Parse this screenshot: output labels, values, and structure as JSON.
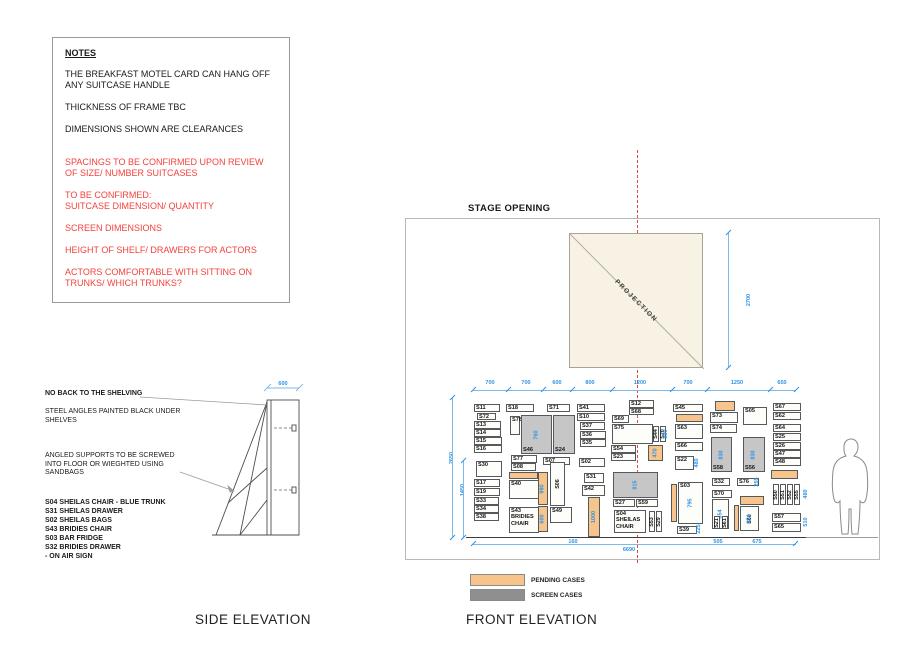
{
  "notes": {
    "title": "NOTES",
    "black_items": [
      "THE BREAKFAST MOTEL CARD CAN HANG OFF ANY SUITCASE HANDLE",
      "THICKNESS OF FRAME TBC",
      "DIMENSIONS SHOWN ARE CLEARANCES"
    ],
    "red_items": [
      "SPACINGS TO BE CONFIRMED UPON REVIEW OF SIZE/ NUMBER SUITCASES",
      "TO BE CONFIRMED:\nSUITCASE DIMENSION/ QUANTITY",
      "SCREEN DIMENSIONS",
      "HEIGHT OF SHELF/ DRAWERS FOR ACTORS",
      "ACTORS COMFORTABLE WITH SITTING ON TRUNKS/ WHICH TRUNKS?"
    ]
  },
  "side_elevation": {
    "title": "SIDE ELEVATION",
    "top_dim": "600",
    "no_back": "NO BACK TO THE SHELVING",
    "steel": "STEEL ANGLES PAINTED BLACK UNDER\nSHELVES",
    "angled": "ANGLED SUPPORTS TO BE SCREWED\nINTO FLOOR OR WIEGHTED USING\nSANDBAGS",
    "case_list": [
      "S04 SHEILAS CHAIR - BLUE TRUNK",
      "S31 SHEILAS DRAWER",
      "S02 SHEILAS BAGS",
      "S43 BRIDIES CHAIR",
      "S03 BAR FRIDGE",
      "S32 BRIDIES DRAWER",
      "- ON AIR SIGN"
    ]
  },
  "front_elevation": {
    "title": "FRONT ELEVATION",
    "stage_label": "STAGE OPENING",
    "projection_label": "PROJECTION",
    "projection_dim": "2700",
    "top_dims": [
      {
        "t": "700",
        "c": 24
      },
      {
        "t": "700",
        "c": 60
      },
      {
        "t": "600",
        "c": 91
      },
      {
        "t": "800",
        "c": 124
      },
      {
        "t": "1200",
        "c": 174
      },
      {
        "t": "700",
        "c": 222
      },
      {
        "t": "1250",
        "c": 271
      },
      {
        "t": "650",
        "c": 316
      }
    ],
    "tick_xs": [
      7,
      42,
      77,
      106,
      146,
      206,
      241,
      304,
      330
    ],
    "cases": [
      {
        "l": "S11",
        "x": 8,
        "y": 6,
        "w": 26,
        "h": 8
      },
      {
        "l": "S72",
        "x": 11,
        "y": 15,
        "w": 19,
        "h": 7
      },
      {
        "l": "S13",
        "x": 8,
        "y": 23,
        "w": 27,
        "h": 8
      },
      {
        "l": "S14",
        "x": 8,
        "y": 31,
        "w": 27,
        "h": 8
      },
      {
        "l": "S15",
        "x": 8,
        "y": 39,
        "w": 28,
        "h": 8
      },
      {
        "l": "S16",
        "x": 8,
        "y": 47,
        "w": 28,
        "h": 8
      },
      {
        "l": "S30",
        "x": 10,
        "y": 63,
        "w": 26,
        "h": 16
      },
      {
        "l": "S17",
        "x": 8,
        "y": 81,
        "w": 26,
        "h": 8
      },
      {
        "l": "S19",
        "x": 8,
        "y": 90,
        "w": 26,
        "h": 8
      },
      {
        "l": "S33",
        "x": 8,
        "y": 99,
        "w": 25,
        "h": 8
      },
      {
        "l": "S34",
        "x": 8,
        "y": 107,
        "w": 25,
        "h": 8
      },
      {
        "l": "S38",
        "x": 8,
        "y": 115,
        "w": 25,
        "h": 8
      },
      {
        "l": "S18",
        "x": 40,
        "y": 6,
        "w": 28,
        "h": 8
      },
      {
        "l": "S78",
        "x": 44,
        "y": 18,
        "w": 10,
        "h": 19
      },
      {
        "l": "S46",
        "x": 55,
        "y": 17,
        "w": 31,
        "h": 39,
        "f": "s",
        "lp": "bl",
        "d": "760"
      },
      {
        "l": "S24",
        "x": 87,
        "y": 17,
        "w": 22,
        "h": 39,
        "f": "s",
        "lp": "bl"
      },
      {
        "l": "S77",
        "x": 45,
        "y": 57,
        "w": 26,
        "h": 8
      },
      {
        "l": "S08",
        "x": 45,
        "y": 65,
        "w": 25,
        "h": 8
      },
      {
        "l": "",
        "x": 43,
        "y": 74,
        "w": 29,
        "h": 7,
        "f": "p"
      },
      {
        "l": "S40",
        "x": 43,
        "y": 82,
        "w": 30,
        "h": 19
      },
      {
        "l": "S43\nBRIDIES\nCHAIR",
        "x": 43,
        "y": 109,
        "w": 30,
        "h": 26
      },
      {
        "l": "S71",
        "x": 81,
        "y": 6,
        "w": 23,
        "h": 8
      },
      {
        "l": "S07",
        "x": 77,
        "y": 59,
        "w": 27,
        "h": 8
      },
      {
        "l": "",
        "x": 72,
        "y": 74,
        "w": 10,
        "h": 33,
        "f": "p",
        "d": "990"
      },
      {
        "l": "",
        "x": 72,
        "y": 108,
        "w": 10,
        "h": 26,
        "f": "p",
        "d": "600"
      },
      {
        "l": "S06",
        "x": 84,
        "y": 64,
        "w": 15,
        "h": 44,
        "v": true
      },
      {
        "l": "S49",
        "x": 84,
        "y": 109,
        "w": 22,
        "h": 16
      },
      {
        "l": "S41",
        "x": 111,
        "y": 6,
        "w": 28,
        "h": 8
      },
      {
        "l": "S10",
        "x": 111,
        "y": 15,
        "w": 28,
        "h": 8
      },
      {
        "l": "S37",
        "x": 114,
        "y": 24,
        "w": 25,
        "h": 8
      },
      {
        "l": "S36",
        "x": 114,
        "y": 33,
        "w": 26,
        "h": 8
      },
      {
        "l": "S35",
        "x": 114,
        "y": 41,
        "w": 26,
        "h": 8
      },
      {
        "l": "S02",
        "x": 113,
        "y": 60,
        "w": 26,
        "h": 9
      },
      {
        "l": "S31",
        "x": 118,
        "y": 75,
        "w": 20,
        "h": 10
      },
      {
        "l": "S42",
        "x": 116,
        "y": 87,
        "w": 23,
        "h": 11
      },
      {
        "l": "",
        "x": 122,
        "y": 99,
        "w": 12,
        "h": 40,
        "f": "p",
        "d": "1000"
      },
      {
        "l": "S12",
        "x": 163,
        "y": 2,
        "w": 25,
        "h": 8
      },
      {
        "l": "S68",
        "x": 163,
        "y": 10,
        "w": 25,
        "h": 7
      },
      {
        "l": "S69",
        "x": 146,
        "y": 17,
        "w": 17,
        "h": 8
      },
      {
        "l": "S75",
        "x": 146,
        "y": 26,
        "w": 41,
        "h": 20
      },
      {
        "l": "S44",
        "x": 187,
        "y": 28,
        "w": 6,
        "h": 16,
        "v": true
      },
      {
        "l": "S20",
        "x": 194,
        "y": 28,
        "w": 6,
        "h": 16,
        "v": true
      },
      {
        "l": "S54",
        "x": 145,
        "y": 47,
        "w": 25,
        "h": 8
      },
      {
        "l": "S23",
        "x": 145,
        "y": 55,
        "w": 25,
        "h": 8
      },
      {
        "l": "",
        "x": 182,
        "y": 47,
        "w": 15,
        "h": 16,
        "f": "p",
        "d": "470"
      },
      {
        "l": "",
        "x": 147,
        "y": 74,
        "w": 45,
        "h": 26,
        "f": "s",
        "d": "815"
      },
      {
        "l": "S27",
        "x": 147,
        "y": 101,
        "w": 22,
        "h": 8
      },
      {
        "l": "S59",
        "x": 170,
        "y": 101,
        "w": 22,
        "h": 8
      },
      {
        "l": "S04\nSHEILAS\nCHAIR",
        "x": 148,
        "y": 112,
        "w": 32,
        "h": 23
      },
      {
        "l": "S53",
        "x": 183,
        "y": 113,
        "w": 6,
        "h": 21,
        "v": true
      },
      {
        "l": "S29",
        "x": 190,
        "y": 113,
        "w": 6,
        "h": 21,
        "v": true
      },
      {
        "l": "S45",
        "x": 207,
        "y": 6,
        "w": 30,
        "h": 8
      },
      {
        "l": "",
        "x": 210,
        "y": 16,
        "w": 27,
        "h": 8,
        "f": "p"
      },
      {
        "l": "S63",
        "x": 209,
        "y": 26,
        "w": 28,
        "h": 15
      },
      {
        "l": "S66",
        "x": 209,
        "y": 44,
        "w": 28,
        "h": 9
      },
      {
        "l": "S22",
        "x": 209,
        "y": 58,
        "w": 19,
        "h": 14
      },
      {
        "l": "",
        "x": 205,
        "y": 86,
        "w": 6,
        "h": 38,
        "f": "p"
      },
      {
        "l": "S03",
        "x": 212,
        "y": 84,
        "w": 25,
        "h": 42,
        "d": "795"
      },
      {
        "l": "S39",
        "x": 211,
        "y": 128,
        "w": 20,
        "h": 8
      },
      {
        "l": "",
        "x": 249,
        "y": 3,
        "w": 20,
        "h": 10,
        "f": "p"
      },
      {
        "l": "S73",
        "x": 244,
        "y": 14,
        "w": 28,
        "h": 11
      },
      {
        "l": "S05",
        "x": 277,
        "y": 9,
        "w": 24,
        "h": 18
      },
      {
        "l": "S74",
        "x": 244,
        "y": 26,
        "w": 27,
        "h": 9
      },
      {
        "l": "S58",
        "x": 245,
        "y": 39,
        "w": 21,
        "h": 35,
        "f": "s",
        "lp": "bl",
        "d": "830"
      },
      {
        "l": "S56",
        "x": 277,
        "y": 39,
        "w": 22,
        "h": 35,
        "f": "s",
        "lp": "bl",
        "d": "830"
      },
      {
        "l": "S32",
        "x": 246,
        "y": 80,
        "w": 18,
        "h": 8
      },
      {
        "l": "S76",
        "x": 271,
        "y": 80,
        "w": 22,
        "h": 8
      },
      {
        "l": "S70",
        "x": 246,
        "y": 92,
        "w": 20,
        "h": 8
      },
      {
        "l": "",
        "x": 246,
        "y": 101,
        "w": 17,
        "h": 30,
        "d": "854"
      },
      {
        "l": "S21",
        "x": 248,
        "y": 118,
        "w": 6,
        "h": 13,
        "v": true
      },
      {
        "l": "S61",
        "x": 256,
        "y": 118,
        "w": 6,
        "h": 13,
        "v": true
      },
      {
        "l": "",
        "x": 274,
        "y": 98,
        "w": 24,
        "h": 9,
        "f": "p"
      },
      {
        "l": "",
        "x": 268,
        "y": 107,
        "w": 5,
        "h": 26,
        "f": "p"
      },
      {
        "l": "S60",
        "x": 274,
        "y": 108,
        "w": 19,
        "h": 25,
        "v": true,
        "d": "854"
      },
      {
        "l": "S67",
        "x": 307,
        "y": 5,
        "w": 28,
        "h": 8
      },
      {
        "l": "S62",
        "x": 307,
        "y": 14,
        "w": 28,
        "h": 8
      },
      {
        "l": "S64",
        "x": 307,
        "y": 26,
        "w": 28,
        "h": 8
      },
      {
        "l": "S25",
        "x": 307,
        "y": 35,
        "w": 28,
        "h": 8
      },
      {
        "l": "S26",
        "x": 307,
        "y": 44,
        "w": 28,
        "h": 8
      },
      {
        "l": "S47",
        "x": 307,
        "y": 52,
        "w": 28,
        "h": 8
      },
      {
        "l": "S48",
        "x": 307,
        "y": 60,
        "w": 28,
        "h": 8
      },
      {
        "l": "",
        "x": 305,
        "y": 72,
        "w": 27,
        "h": 9,
        "f": "p"
      },
      {
        "l": "S50",
        "x": 307,
        "y": 86,
        "w": 6,
        "h": 21,
        "v": true
      },
      {
        "l": "S51",
        "x": 314,
        "y": 86,
        "w": 6,
        "h": 21,
        "v": true
      },
      {
        "l": "S52",
        "x": 321,
        "y": 86,
        "w": 6,
        "h": 21,
        "v": true
      },
      {
        "l": "S55",
        "x": 328,
        "y": 86,
        "w": 6,
        "h": 21,
        "v": true
      },
      {
        "l": "S57",
        "x": 306,
        "y": 115,
        "w": 29,
        "h": 9
      },
      {
        "l": "S65",
        "x": 306,
        "y": 125,
        "w": 29,
        "h": 9
      }
    ],
    "dims": [
      {
        "t": "890",
        "x": 200,
        "y": 36,
        "v": true
      },
      {
        "t": "2650",
        "x": -14,
        "y": 60,
        "v": true
      },
      {
        "t": "1450",
        "x": -3,
        "y": 92,
        "v": true
      },
      {
        "t": "480",
        "x": 231,
        "y": 65,
        "v": true
      },
      {
        "t": "225",
        "x": 233,
        "y": 131,
        "v": true
      },
      {
        "t": "255",
        "x": 291,
        "y": 84,
        "v": true
      },
      {
        "t": "480",
        "x": 340,
        "y": 96,
        "v": true
      },
      {
        "t": "510",
        "x": 340,
        "y": 124,
        "v": true
      },
      {
        "t": "160",
        "x": 107,
        "y": 144
      },
      {
        "t": "505",
        "x": 252,
        "y": 144
      },
      {
        "t": "675",
        "x": 291,
        "y": 144
      },
      {
        "t": "6690",
        "x": 163,
        "y": 152
      }
    ]
  },
  "legend": {
    "items": [
      {
        "label": "PENDING CASES",
        "color": "#f7c48c"
      },
      {
        "label": "SCREEN CASES",
        "color": "#8f8f8f"
      }
    ]
  },
  "colors": {
    "pending": "#f7c48c",
    "screen_case": "#c6c6c6",
    "dim_blue": "#2e93e6",
    "note_red": "#f4423c",
    "centerline_red": "#e2453a",
    "projection_fill": "#f7f2e3"
  }
}
